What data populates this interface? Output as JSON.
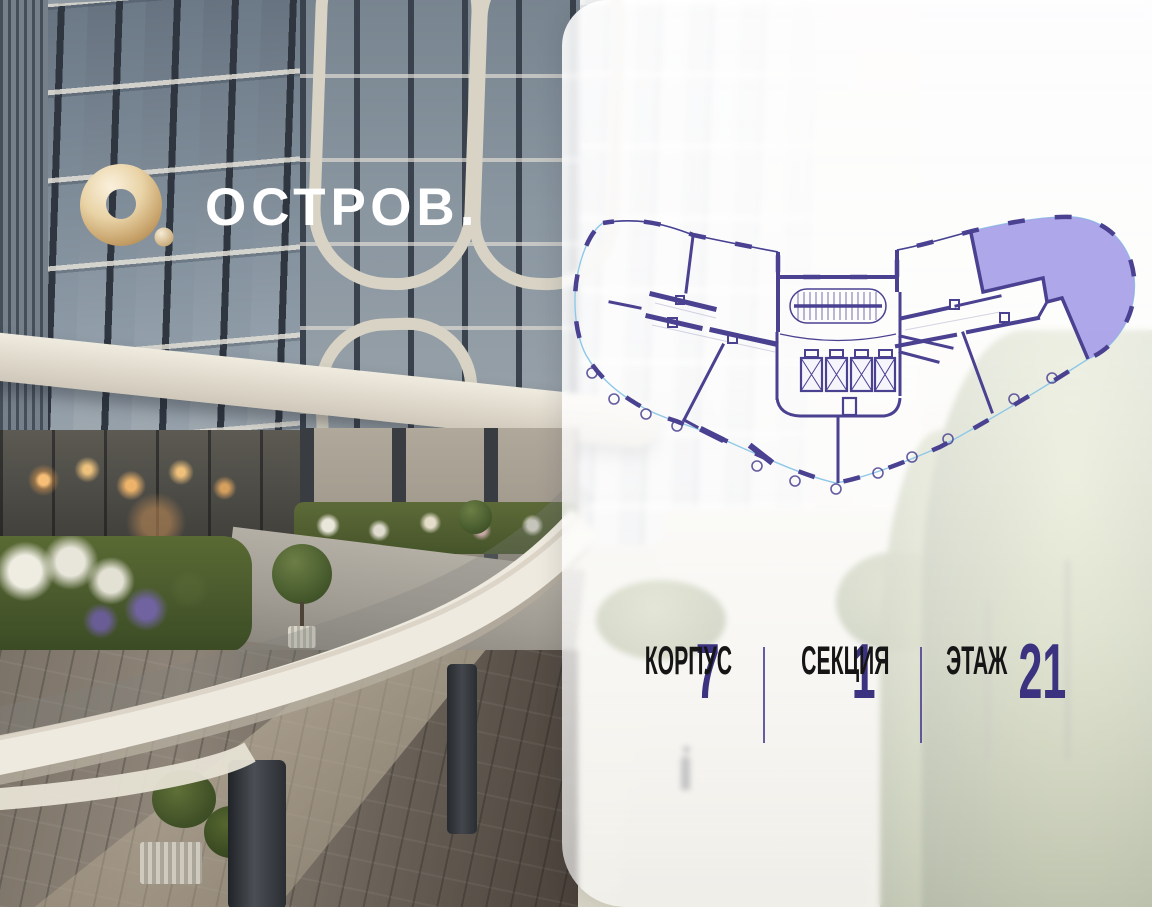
{
  "logo": {
    "text": "ОСТРОВ.",
    "mark": "gold-ring-logo",
    "gold_color": "#cfae77",
    "text_color": "#ffffff"
  },
  "panel": {
    "stats": [
      {
        "value": "7",
        "label": "КОРПУС"
      },
      {
        "value": "1",
        "label": "СЕКЦИЯ"
      },
      {
        "value": "21",
        "label": "ЭТАЖ"
      }
    ],
    "divider_color": "#4b4191",
    "value_color": "#3b3380",
    "label_color": "#151515"
  },
  "floor_plan": {
    "description": "floor plate schematic with one highlighted unit",
    "colors": {
      "walls": "#4a4191",
      "outline_thin": "#8fc8e8",
      "highlight_fill": "#a7a0e8"
    }
  }
}
